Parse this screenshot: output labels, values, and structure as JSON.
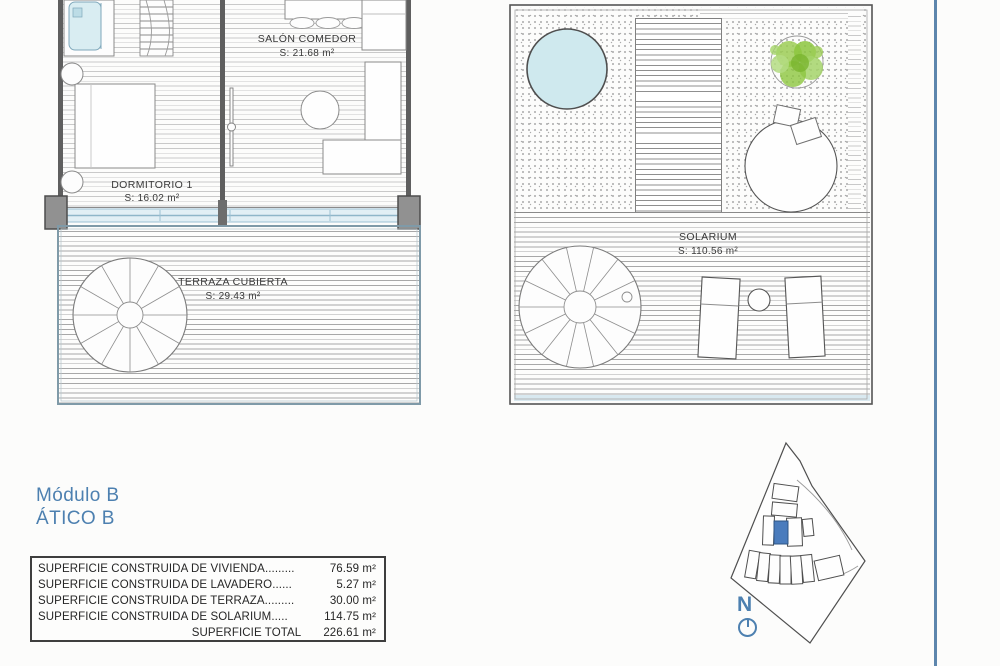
{
  "title": {
    "line1": "Módulo B",
    "line2": "ÁTICO B"
  },
  "plan_left": {
    "salon": {
      "name": "SALÓN COMEDOR",
      "area": "S: 21.68 m²"
    },
    "dormitorio": {
      "name": "DORMITORIO 1",
      "area": "S: 16.02 m²"
    },
    "terraza": {
      "name": "TERRAZA CUBIERTA",
      "area": "S: 29.43 m²"
    }
  },
  "plan_right": {
    "solarium": {
      "name": "SOLARIUM",
      "area": "S: 110.56 m²"
    }
  },
  "surface_table": {
    "rows": [
      {
        "label": "SUPERFICIE CONSTRUIDA DE VIVIENDA.........",
        "value": "76.59 m²"
      },
      {
        "label": "SUPERFICIE CONSTRUIDA DE LAVADERO......",
        "value": "5.27 m²"
      },
      {
        "label": "SUPERFICIE CONSTRUIDA DE TERRAZA.........",
        "value": "30.00 m²"
      },
      {
        "label": "SUPERFICIE CONSTRUIDA DE SOLARIUM.....",
        "value": "114.75 m²"
      }
    ],
    "total": {
      "label": "SUPERFICIE TOTAL",
      "value": "226.61 m²"
    }
  },
  "compass": {
    "label": "N"
  },
  "colors": {
    "accent_blue": "#4d80b0",
    "divider_blue": "#5d86ad",
    "pool_fill": "#cfe9ee",
    "plant_green": "#8cc63e",
    "highlighted_unit": "#4a7cbd",
    "window_band": "#e2eff5"
  }
}
